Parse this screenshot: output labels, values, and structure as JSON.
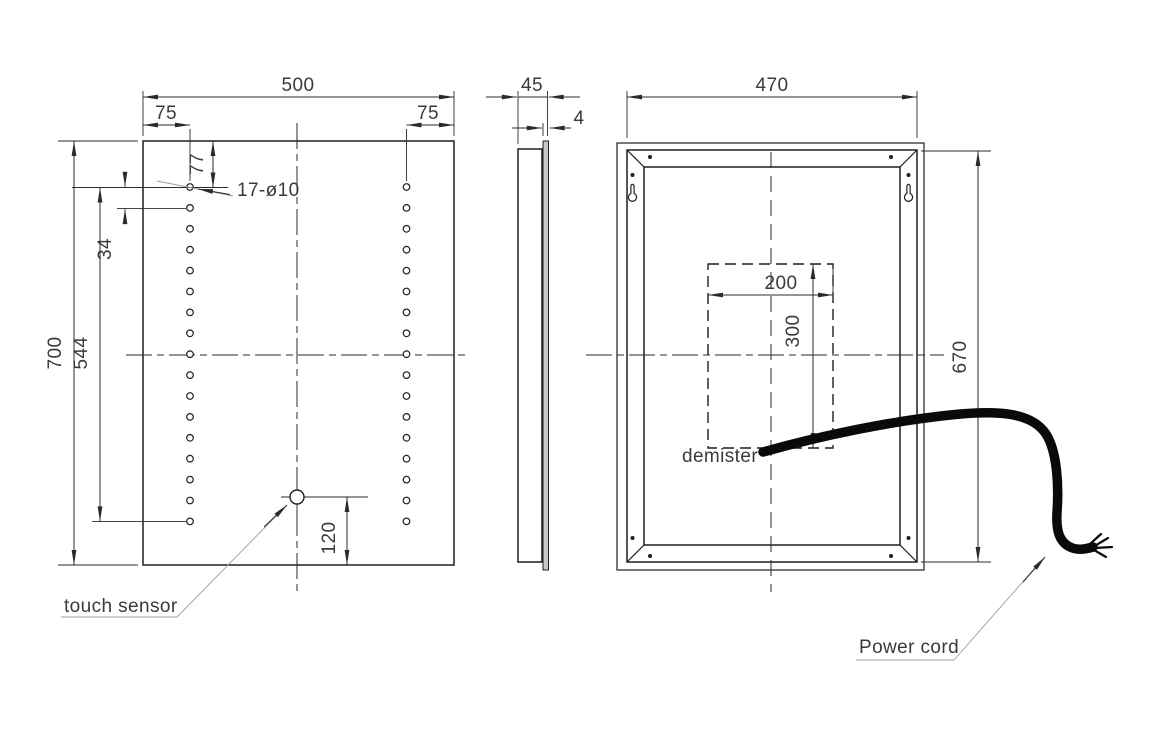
{
  "front": {
    "overall_width": "500",
    "overall_height": "700",
    "hole_inset_left": "75",
    "hole_inset_right": "75",
    "first_hole_offset": "77",
    "hole_pitch": "34",
    "hole_column_span": "544",
    "sensor_offset_bottom": "120",
    "holes_callout": "17-ø10",
    "sensor_callout": "touch sensor",
    "holes_per_column": 17
  },
  "side": {
    "depth": "45",
    "glass_thickness": "4"
  },
  "back": {
    "overall_width": "470",
    "overall_height": "670",
    "demister_width": "200",
    "demister_height": "300",
    "demister_callout": "demister",
    "cord_callout": "Power cord"
  },
  "colors": {
    "background": "#ffffff",
    "line": "#1f1f1f",
    "dim": "#2b2b2b",
    "leader": "#9e9e9e",
    "text": "#3a3a3a",
    "cord": "#0a0a0a",
    "glass": "#c9c9c9"
  }
}
